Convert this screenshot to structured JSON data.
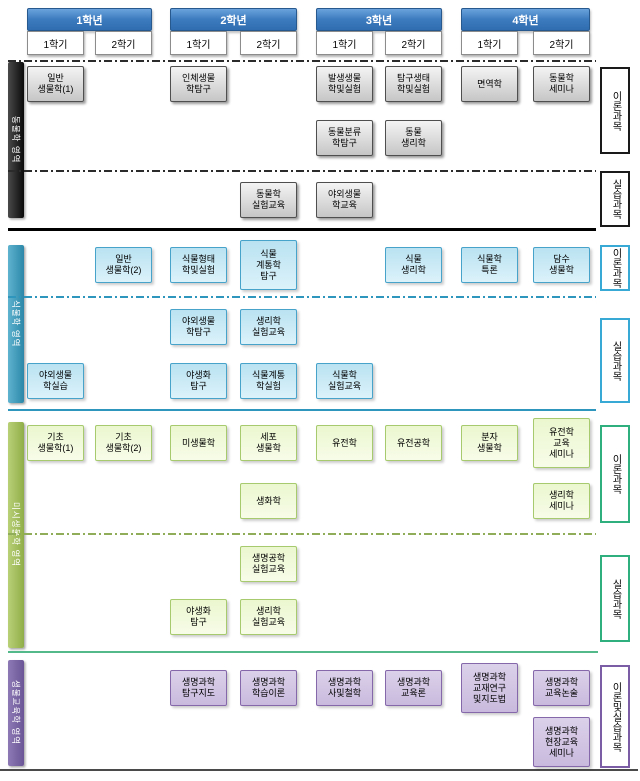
{
  "diagram": {
    "years": [
      {
        "label": "1학년",
        "semesters": [
          "1학기",
          "2학기"
        ]
      },
      {
        "label": "2학년",
        "semesters": [
          "1학기",
          "2학기"
        ]
      },
      {
        "label": "3학년",
        "semesters": [
          "1학기",
          "2학기"
        ]
      },
      {
        "label": "4학년",
        "semesters": [
          "1학기",
          "2학기"
        ]
      }
    ],
    "header_colors": {
      "year_top": "#6aa3dc",
      "year_bottom": "#2f6cb0",
      "year_border": "#27598f"
    },
    "sections": [
      {
        "name": "zoology-area",
        "bar_label": "동물학 영역",
        "right_labels": [
          {
            "text": "이론과목"
          },
          {
            "text": "실습과목"
          }
        ],
        "colors": {
          "bar_light": "#4a4a4a",
          "bar_dark": "#0a0a0a",
          "box_top": "#f4f4f4",
          "box_bottom": "#c6c6c6",
          "box_border": "#4f4f4f",
          "dash": "#2b2b2b",
          "bottom_line": "#000000",
          "label_border": "#1a1a1a",
          "shadow": "rgba(0,0,0,0.4)"
        },
        "courses": [
          {
            "label": "일반\n생물학(1)",
            "col": 1,
            "row": 0
          },
          {
            "label": "인체생물\n학탐구",
            "col": 3,
            "row": 0
          },
          {
            "label": "발생생물\n학및실험",
            "col": 5,
            "row": 0
          },
          {
            "label": "탐구생태\n학및실험",
            "col": 6,
            "row": 0
          },
          {
            "label": "면역학",
            "col": 7,
            "row": 0
          },
          {
            "label": "동물학\n세미나",
            "col": 8,
            "row": 0
          },
          {
            "label": "동물분류\n학탐구",
            "col": 5,
            "row": 1
          },
          {
            "label": "동물\n생리학",
            "col": 6,
            "row": 1
          },
          {
            "label": "동물학\n실험교육",
            "col": 4,
            "row": 2
          },
          {
            "label": "야외생물\n학교육",
            "col": 5,
            "row": 2
          }
        ]
      },
      {
        "name": "botany-area",
        "bar_label": "식물학 영역",
        "right_labels": [
          {
            "text": "이론과목"
          },
          {
            "text": "실습과목"
          }
        ],
        "colors": {
          "bar_light": "#5fb3cf",
          "bar_dark": "#2b87a8",
          "box_top": "#b9e2f1",
          "box_bottom": "#dcf2fa",
          "box_border": "#47a3ca",
          "dash": "#2e96bd",
          "bottom_line": "#2e96bd",
          "label_border": "#38a9d4",
          "shadow": "rgba(0,0,0,0.2)"
        },
        "courses": [
          {
            "label": "일반\n생물학(2)",
            "col": 2,
            "row": 0
          },
          {
            "label": "식물형태\n학및실험",
            "col": 3,
            "row": 0
          },
          {
            "label": "식물\n계통학\n탐구",
            "col": 4,
            "row": 0
          },
          {
            "label": "식물\n생리학",
            "col": 6,
            "row": 0
          },
          {
            "label": "식물학\n특론",
            "col": 7,
            "row": 0
          },
          {
            "label": "담수\n생물학",
            "col": 8,
            "row": 0
          },
          {
            "label": "야외생물\n학탐구",
            "col": 3,
            "row": 1
          },
          {
            "label": "생리학\n실험교육",
            "col": 4,
            "row": 1
          },
          {
            "label": "야외생물\n학실습",
            "col": 1,
            "row": 2
          },
          {
            "label": "야생화\n탐구",
            "col": 3,
            "row": 2
          },
          {
            "label": "식물계통\n학실험",
            "col": 4,
            "row": 2
          },
          {
            "label": "식물학\n실험교육",
            "col": 5,
            "row": 2
          }
        ]
      },
      {
        "name": "microbiology-area",
        "bar_label": "미시생물학 영역",
        "right_labels": [
          {
            "text": "이론과목"
          },
          {
            "text": "실습과목"
          }
        ],
        "colors": {
          "bar_light": "#b9d077",
          "bar_dark": "#8fae48",
          "box_top": "#ebf7cf",
          "box_bottom": "#f7fce8",
          "box_border": "#a6ca6d",
          "dash": "#90ad59",
          "bottom_line": "#53b98b",
          "label_border": "#2fae7e",
          "shadow": "rgba(0,0,0,0.2)"
        },
        "courses": [
          {
            "label": "기초\n생물학(1)",
            "col": 1,
            "row": 0
          },
          {
            "label": "기초\n생물학(2)",
            "col": 2,
            "row": 0
          },
          {
            "label": "미생물학",
            "col": 3,
            "row": 0
          },
          {
            "label": "세포\n생물학",
            "col": 4,
            "row": 0
          },
          {
            "label": "유전학",
            "col": 5,
            "row": 0
          },
          {
            "label": "유전공학",
            "col": 6,
            "row": 0
          },
          {
            "label": "분자\n생물학",
            "col": 7,
            "row": 0
          },
          {
            "label": "유전학\n교육\n세미나",
            "col": 8,
            "row": 0
          },
          {
            "label": "생화학",
            "col": 4,
            "row": 1
          },
          {
            "label": "생리학\n세미나",
            "col": 8,
            "row": 1
          },
          {
            "label": "생명공학\n실험교육",
            "col": 4,
            "row": 2
          },
          {
            "label": "야생화\n탐구",
            "col": 3,
            "row": 3
          },
          {
            "label": "생리학\n실험교육",
            "col": 4,
            "row": 3
          }
        ]
      },
      {
        "name": "biology-education-area",
        "bar_label": "생물교육학 영역",
        "right_labels": [
          {
            "text": "이론및실습과목"
          }
        ],
        "colors": {
          "bar_light": "#8d7ab5",
          "bar_dark": "#6b5596",
          "box_top": "#dbd1ea",
          "box_bottom": "#c9badd",
          "box_border": "#8468aa",
          "dash": "#8468aa",
          "bottom_line": "#4a4a4a",
          "label_border": "#7a5da5",
          "shadow": "rgba(0,0,0,0.2)"
        },
        "courses": [
          {
            "label": "생명과학\n탐구지도",
            "col": 3,
            "row": 0
          },
          {
            "label": "생명과학\n학습이론",
            "col": 4,
            "row": 0
          },
          {
            "label": "생명과학\n사및철학",
            "col": 5,
            "row": 0
          },
          {
            "label": "생명과학\n교육론",
            "col": 6,
            "row": 0
          },
          {
            "label": "생명과학\n교재연구\n및지도법",
            "col": 7,
            "row": 0
          },
          {
            "label": "생명과학\n교육논술",
            "col": 8,
            "row": 0
          },
          {
            "label": "생명과학\n현장교육\n세미나",
            "col": 8,
            "row": 1
          }
        ]
      }
    ]
  }
}
